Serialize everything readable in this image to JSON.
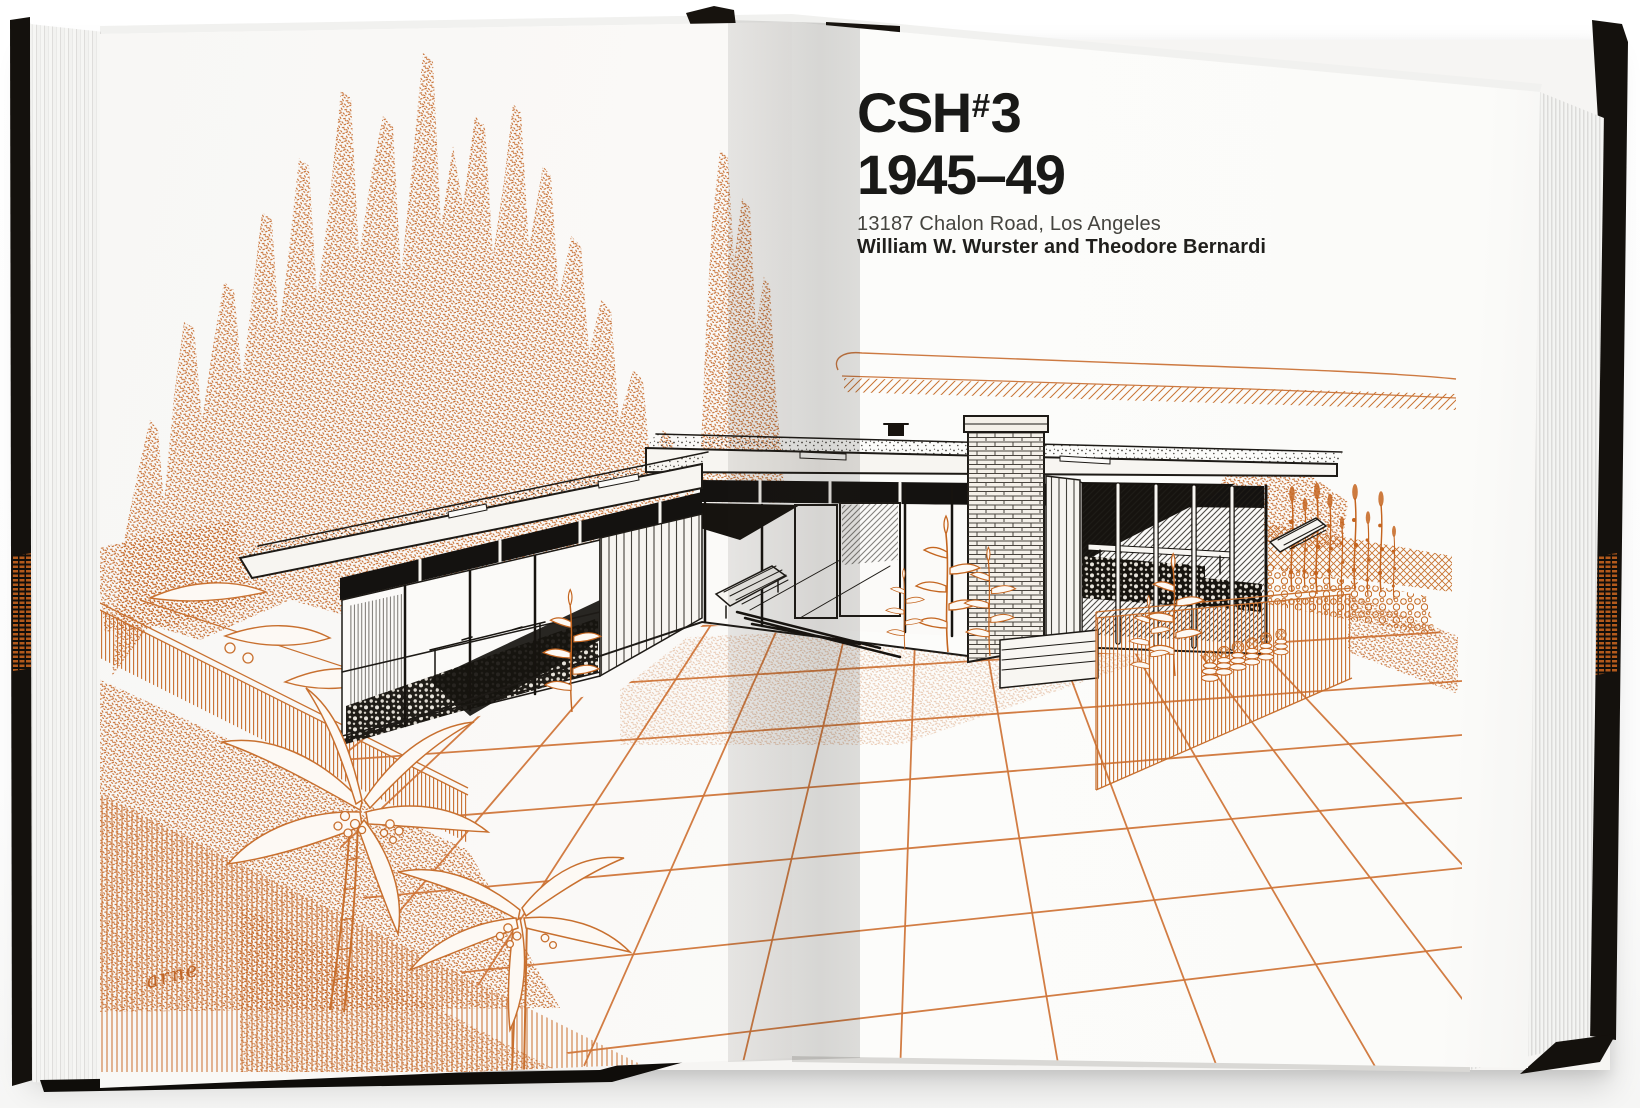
{
  "book": {
    "title_block": {
      "project_code_prefix": "CSH",
      "project_code_hash": "#",
      "project_code_number": "3",
      "years": "1945–49",
      "address": "13187 Chalon Road, Los Angeles",
      "architects": "William W. Wurster and Theodore Bernardi"
    },
    "illustration": {
      "artist_signature": "arne",
      "subject": "Case Study House #3 perspective rendering with cypress trees, patio and garden"
    },
    "colors": {
      "ink_orange": "#c36423",
      "ink_orange_light": "#d0763a",
      "ink_black": "#1d1a16",
      "paper_white": "#fbfaf8",
      "cover_black": "#14110d",
      "cover_brick_orange": "#b35a1c"
    }
  }
}
